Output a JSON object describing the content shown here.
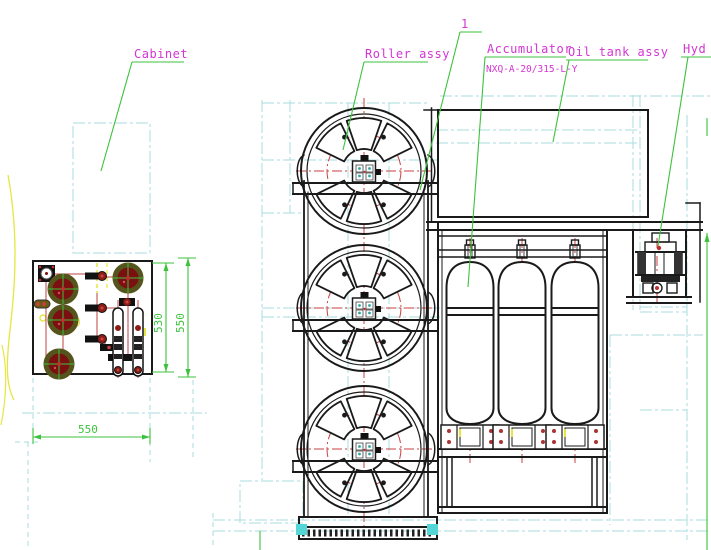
{
  "labels": {
    "cabinet": "Cabinet",
    "roller_assy": "Roller assy",
    "balloon_1": "1",
    "accumulator": "Accumulator",
    "accumulator_model": "NXQ-A-20/315-L-Y",
    "oil_tank_assy": "Oil tank assy",
    "hyd": "Hyd"
  },
  "dimensions": {
    "cabinet_width": "550",
    "cabinet_inner_height": "530",
    "cabinet_outer_height": "550"
  },
  "colors": {
    "label_magenta": "#d435d4",
    "leader_green": "#3dc23d",
    "construction_cyan": "#a8dde0",
    "centerline_red": "#c94040",
    "outline_black": "#1a1a1a",
    "highlight_teal": "#55d6d6",
    "component_red": "#8b1d15",
    "component_olive": "#54541c",
    "component_yellow": "#e6e642"
  }
}
